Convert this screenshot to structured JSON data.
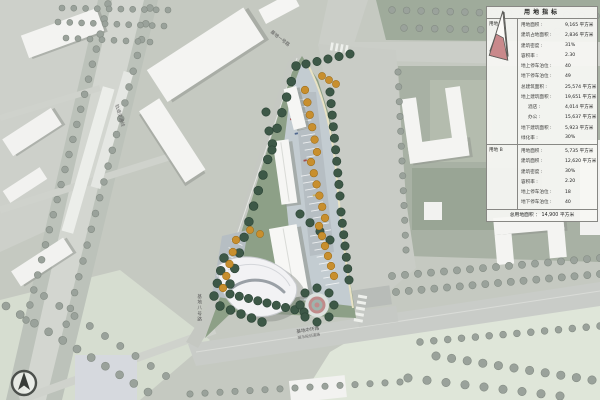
{
  "indicator_table": {
    "title": "用地指标",
    "total": "总用地面积 ： 14,900 平方米",
    "parcels": [
      {
        "name": "用地 A",
        "rows": [
          {
            "label": "用地面积 :",
            "value": "9,165 平方米"
          },
          {
            "label": "建筑占地面积 :",
            "value": "2,836 平方米"
          },
          {
            "label": "建筑密度 :",
            "value": "31%"
          },
          {
            "label": "容积率 :",
            "value": "2.30"
          },
          {
            "label": "地上停车泊位 :",
            "value": "40"
          },
          {
            "label": "地下停车泊位 :",
            "value": "49"
          },
          {
            "label": "总建筑面积 :",
            "value": "25,574 平方米"
          },
          {
            "label": "地上建筑面积 :",
            "value": "19,651 平方米"
          },
          {
            "label": "酒店 :",
            "value": "4,014 平方米",
            "indent": true
          },
          {
            "label": "办公 :",
            "value": "15,637 平方米",
            "indent": true
          },
          {
            "label": "地下建筑面积 :",
            "value": "5,923 平方米"
          },
          {
            "label": "绿化率 :",
            "value": "30%"
          }
        ]
      },
      {
        "name": "用地 B",
        "rows": [
          {
            "label": "用地面积 :",
            "value": "5,735 平方米"
          },
          {
            "label": "建筑面积 :",
            "value": "12,620 平方米"
          },
          {
            "label": "建筑密度 :",
            "value": "30%"
          },
          {
            "label": "容积率 :",
            "value": "2.20"
          },
          {
            "label": "地上停车泊位 :",
            "value": "18"
          },
          {
            "label": "地下停车泊位 :",
            "value": "40"
          }
        ]
      }
    ]
  },
  "map_labels": {
    "road_bottom_main": "基地中环路",
    "road_bottom_sub": "城市规划道路",
    "road_west": "基地八号路",
    "road_top": "基地一号路",
    "rail_line": "轨道交通线"
  },
  "colors": {
    "parcel_icon_fill": "#c9898b",
    "tree_green": "#3d5847",
    "tree_orange": "#c88f2e",
    "plaza_ring": "#c08b8b"
  }
}
